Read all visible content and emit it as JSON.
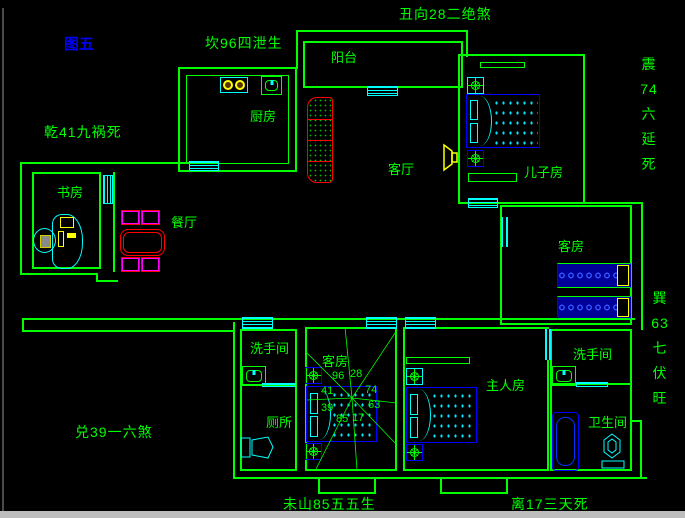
{
  "figure_label": "图五",
  "fengshui": {
    "north": "坎96四泄生",
    "northeast": "丑向28二绝煞",
    "northwest": "乾41九祸死",
    "west": "兑39一六煞",
    "southwest": "未山85五五生",
    "south": "离17三天死",
    "east_upper": "震\n74\n六\n延\n死",
    "east_lower": "巽\n63\n七\n伏\n旺"
  },
  "rooms": {
    "balcony": "阳台",
    "kitchen": "厨房",
    "living_room": "客厅",
    "sons_room": "儿子房",
    "study": "书房",
    "dining_room": "餐厅",
    "guest_room_right": "客房",
    "guest_room_bottom": "客房",
    "washroom_left": "洗手间",
    "toilet_room": "厕所",
    "master_bedroom": "主人房",
    "washroom_right": "洗手间",
    "bathroom": "卫生间"
  },
  "compass": {
    "top_left": "96",
    "top_right": "28",
    "mid_left": "41",
    "mid_right": "74",
    "lower_left": "39",
    "lower_right": "63",
    "bottom_left": "85",
    "bottom_right": "17"
  },
  "colors": {
    "background": "#000000",
    "walls": "#00ff00",
    "openings": "#00ffff",
    "furniture_blue": "#0000ff",
    "accent_red": "#ff0000",
    "accent_magenta": "#ff00ff",
    "accent_yellow": "#ffff00",
    "labels_green": "#00ff00",
    "figure_label_blue": "#0000ff",
    "status_bar": "#bdbdbd"
  }
}
